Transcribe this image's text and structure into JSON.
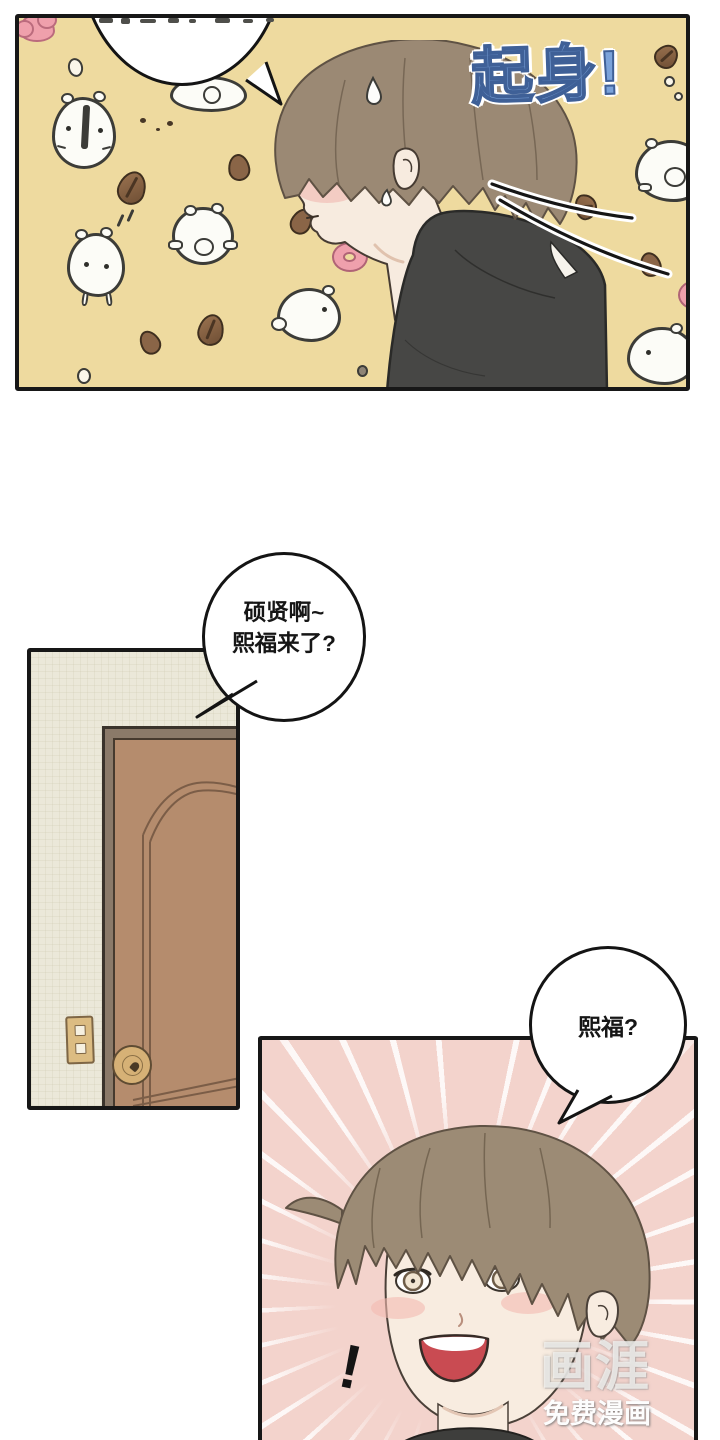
{
  "page": {
    "width": 720,
    "height": 1440,
    "background": "#ffffff"
  },
  "panel_bedroom": {
    "sfx_text": "起身!",
    "colors": {
      "background": "#eeda9f",
      "sfx_fill": "#7ba3da",
      "sfx_outline": "#3f6097",
      "hair": "#9b8974",
      "skin": "#f7ebdf",
      "shirt": "#474745"
    }
  },
  "speech_bubbles": {
    "greeting": {
      "line1": "硕贤啊~",
      "line2": "熙福来了?"
    },
    "question": {
      "text": "熙福?"
    }
  },
  "panel_door": {
    "colors": {
      "wall": "#ebe8d9",
      "frame": "#8b7a69",
      "door": "#b58c6d",
      "knob": "#d6b176"
    }
  },
  "panel_pink": {
    "exclamation": "!",
    "colors": {
      "background": "#f3d3cc",
      "hair": "#9c8b75",
      "mouth": "#c94b52"
    }
  },
  "watermark": {
    "logo": "画涯",
    "caption": "免费漫画"
  }
}
